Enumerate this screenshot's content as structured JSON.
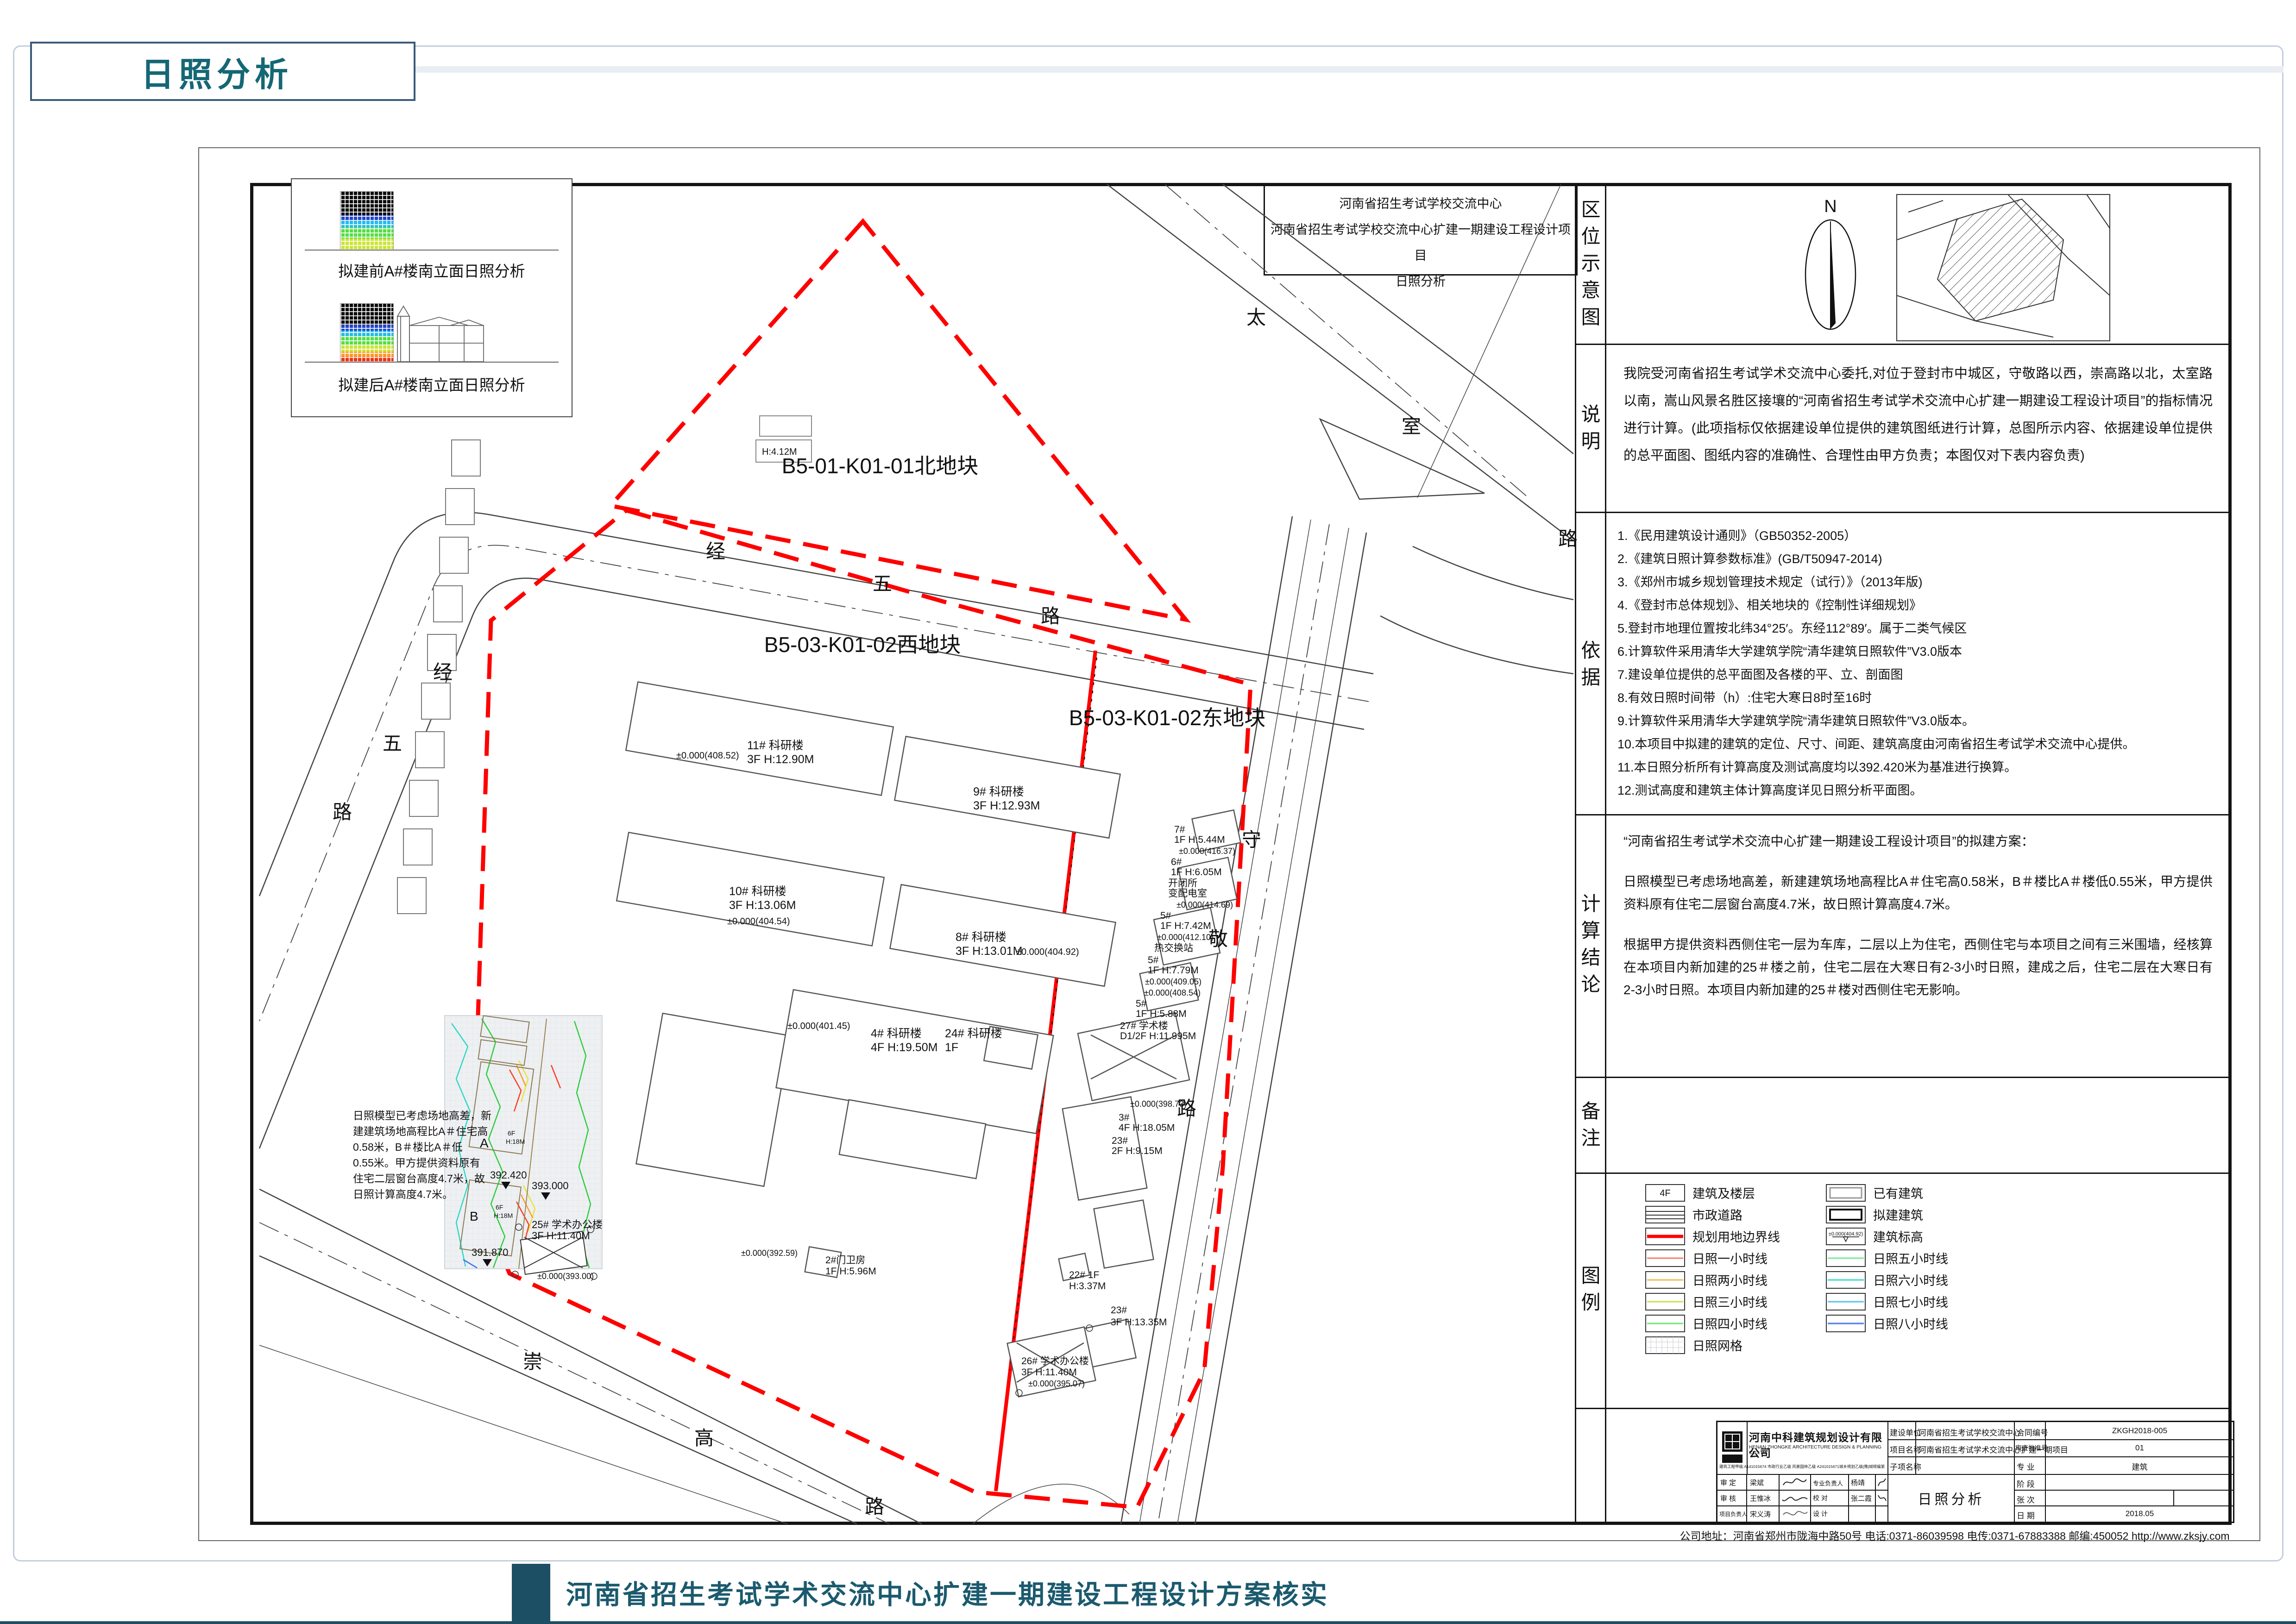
{
  "page": {
    "tab_title": "日照分析",
    "footer_title": "河南省招生考试学术交流中心扩建一期建设工程设计方案核实",
    "accent_color": "#1c4f63",
    "boundary_color": "#ff0000"
  },
  "title_box": {
    "line1": "河南省招生考试学校交流中心",
    "line2": "河南省招生考试学校交流中心扩建一期建设工程设计项目",
    "line3": "日照分析"
  },
  "sidebar": {
    "location_label": "区位示意图",
    "north": "N",
    "notes_label": "说明",
    "notes_text": "我院受河南省招生考试学术交流中心委托,对位于登封市中城区，守敬路以西，崇高路以北，太室路以南，嵩山风景名胜区接壤的“河南省招生考试学术交流中心扩建一期建设工程设计项目”的指标情况进行计算。(此项指标仅依据建设单位提供的建筑图纸进行计算，总图所示内容、依据建设单位提供的总平面图、图纸内容的准确性、合理性由甲方负责；本图仅对下表内容负责)",
    "basis_label": "依据",
    "basis_items": [
      "1.《民用建筑设计通则》（GB50352-2005）",
      "2.《建筑日照计算参数标准》(GB/T50947-2014)",
      "3.《郑州市城乡规划管理技术规定（试行）》（2013年版)",
      "4.《登封市总体规划》、相关地块的《控制性详细规划》",
      "5.登封市地理位置按北纬34°25′。东经112°89′。属于二类气候区",
      "6.计算软件采用清华大学建筑学院“清华建筑日照软件”V3.0版本",
      "7.建设单位提供的总平面图及各楼的平、立、剖面图",
      "8.有效日照时间带（h）:住宅大寒日8时至16时",
      "9.计算软件采用清华大学建筑学院“清华建筑日照软件”V3.0版本。",
      "10.本项目中拟建的建筑的定位、尺寸、间距、建筑高度由河南省招生考试学术交流中心提供。",
      "11.本日照分析所有计算高度及测试高度均以392.420米为基准进行换算。",
      "12.测试高度和建筑主体计算高度详见日照分析平面图。"
    ],
    "conclusion_label": "计算结论",
    "conclusion_p1": "“河南省招生考试学术交流中心扩建一期建设工程设计项目”的拟建方案：",
    "conclusion_p2": "日照模型已考虑场地高差，新建建筑场地高程比A＃住宅高0.58米，B＃楼比A＃楼低0.55米，甲方提供资料原有住宅二层窗台高度4.7米，故日照计算高度4.7米。",
    "conclusion_p3": "根据甲方提供资料西侧住宅一层为车库，二层以上为住宅，西侧住宅与本项目之间有三米围墙，经核算在本项目内新加建的25＃楼之前，住宅二层在大寒日有2-3小时日照，建成之后，住宅二层在大寒日有2-3小时日照。本项目内新加建的25＃楼对西侧住宅无影响。",
    "remarks_label": "备注",
    "legend_label": "图例"
  },
  "legend": {
    "left": [
      {
        "label": "建筑及楼层",
        "text": "4F"
      },
      {
        "label": "市政道路"
      },
      {
        "label": "规划用地边界线",
        "color": "#ff0000"
      },
      {
        "label": "日照一小时线",
        "color": "#f4907a"
      },
      {
        "label": "日照两小时线",
        "color": "#f2c368"
      },
      {
        "label": "日照三小时线",
        "color": "#cfe26a"
      },
      {
        "label": "日照四小时线",
        "color": "#7fe87f"
      },
      {
        "label": "日照网格"
      }
    ],
    "right": [
      {
        "label": "已有建筑"
      },
      {
        "label": "拟建建筑"
      },
      {
        "label": "建筑标高",
        "text": "±0.000(404.92)"
      },
      {
        "label": "日照五小时线",
        "color": "#8fe8a8"
      },
      {
        "label": "日照六小时线",
        "color": "#4fe0d0"
      },
      {
        "label": "日照七小时线",
        "color": "#6cc8f0"
      },
      {
        "label": "日照八小时线",
        "color": "#5b85e8"
      }
    ]
  },
  "plan": {
    "parcels": {
      "north": "B5-01-K01-01北地块",
      "west": "B5-03-K01-02西地块",
      "east": "B5-03-K01-02东地块"
    },
    "roads": {
      "jingwu": [
        "经",
        "五",
        "路"
      ],
      "taishi": [
        "太",
        "室",
        "路"
      ],
      "shoujing": [
        "守",
        "敬",
        "路"
      ],
      "chonggao": [
        "崇",
        "高",
        "路"
      ]
    },
    "insets": {
      "before": "拟建前A#楼南立面日照分析",
      "after": "拟建后A#楼南立面日照分析"
    },
    "note_lines": [
      "日照模型已考虑场地高差，新",
      "建建筑场地高程比A＃住宅高",
      "0.58米，B＃楼比A＃低",
      "0.55米。甲方提供资料原有",
      "住宅二层窗台高度4.7米，故",
      "日照计算高度4.7米。"
    ],
    "small_label": "H:4.12M",
    "buildings": {
      "wb": [
        {
          "n": "11# 科研楼",
          "s": "3F H:12.90M",
          "e": "±0.000(408.52)"
        },
        {
          "n": "9# 科研楼",
          "s": "3F H:12.93M"
        },
        {
          "n": "10# 科研楼",
          "s": "3F H:13.06M",
          "e": "±0.000(404.54)"
        },
        {
          "n": "8# 科研楼",
          "s": "3F H:13.01M",
          "e": "±0.000(404.92)"
        },
        {
          "n": "4# 科研楼",
          "s": "4F H:19.50M",
          "e": "±0.000(401.45)"
        },
        {
          "n": "24# 科研楼",
          "s": "1F"
        }
      ],
      "eb": [
        {
          "n": "7#",
          "s": "1F H:5.44M",
          "e": "±0.000(416.37)"
        },
        {
          "n": "6#",
          "s": "1F H:6.05M",
          "x1": "开闭所",
          "x2": "变配电室",
          "e": "±0.000(414.69)"
        },
        {
          "n": "5#",
          "s": "1F H:7.42M",
          "e": "±0.000(412.10)",
          "x1": "热交换站"
        },
        {
          "n": "5#",
          "s": "1F H:7.79M",
          "e": "±0.000(409.05)"
        },
        {
          "n": "5#",
          "s": "1F H:5.88M",
          "e": "±0.000(408.54)"
        },
        {
          "n": "27# 学术楼",
          "s": "D1/2F H:11.995M",
          "e": "±0.000(398.73)"
        },
        {
          "n": "3#",
          "s": "4F H:18.05M"
        },
        {
          "n": "23#",
          "s": "2F H:9.15M"
        }
      ],
      "sb": [
        {
          "n": "23#",
          "s": "3F H:13.35M"
        },
        {
          "n": "22# 1F",
          "s": "H:3.37M"
        },
        {
          "n": "26# 学术办公楼",
          "s": "3F H:11.40M",
          "e": "±0.000(395.07)"
        },
        {
          "n": "2#门卫房",
          "s": "1F H:5.96M",
          "e": "±0.000(392.59)"
        }
      ]
    },
    "zone": {
      "a": "A",
      "b": "B",
      "af": "6F",
      "ah": "H:18M",
      "b25_1": "25# 学术办公楼",
      "b25_2": "3F H:11.40M",
      "b25_3": "±0.000(393.00)",
      "m1": "392.420",
      "m2": "393.000",
      "m3": "391.870"
    }
  },
  "titleblock": {
    "company_cn": "河南中科建筑规划设计有限公司",
    "company_en": "HENAN ZHONGKE ARCHITECTURE DESIGN & PLANNING CO.LTD.",
    "cert": "建筑工程甲级:A141015674 市政行业乙级 风景园林乙级 A241015671城乡规划乙级[豫]城规编第（152009）",
    "owner_label": "建设单位",
    "owner": "河南省招生考试学校交流中心",
    "project_label": "项目名称",
    "project": "河南省招生考试学术交流中心扩建一期项目",
    "sub_label": "子项名称",
    "sub": "",
    "contract_label": "合同编号",
    "contract": "ZKGH2018-005",
    "review_label": "审查批准号",
    "review": "01",
    "major_label": "专  业",
    "major": "建筑",
    "stage_label": "阶  段",
    "stage": "",
    "sheet_label": "张  次",
    "sheet": "",
    "date_label": "日  期",
    "date": "2018.05",
    "drawing_title": "日照分析",
    "approve_label": "审  定",
    "approve": "梁斌",
    "check_label": "审  核",
    "check": "王惟冰",
    "pm_label": "项目负责人",
    "pm": "宋义涛",
    "lead_label": "专业负责人",
    "lead": "杨靖",
    "proof_label": "校  对",
    "proof": "张二霞",
    "design_label": "设  计",
    "address": "公司地址：河南省郑州市陇海中路50号  电话:0371-86039598  电传:0371-67883388  邮编:450052  http://www.zksjy.com"
  }
}
